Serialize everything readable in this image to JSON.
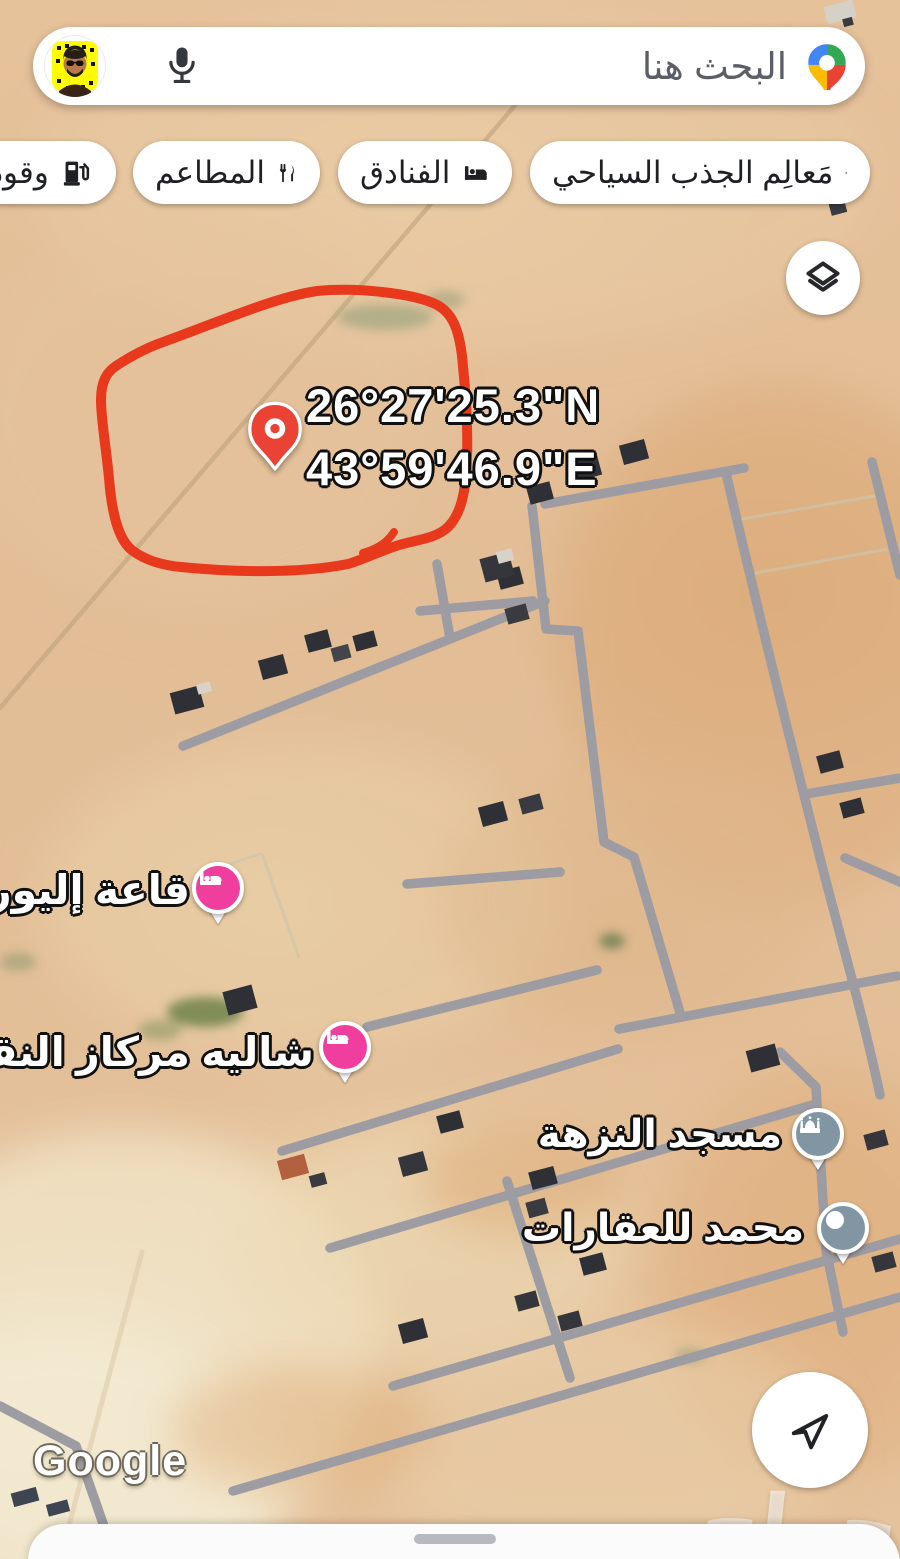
{
  "app": {
    "title": "Google Maps satellite view"
  },
  "search": {
    "placeholder": "البحث هنا"
  },
  "toolbar_chips": [
    {
      "label": "مَعالِم الجذب السياحي",
      "icon": "attractions-icon"
    },
    {
      "label": "الفنادق",
      "icon": "hotels-icon"
    },
    {
      "label": "المطاعم",
      "icon": "restaurants-icon"
    },
    {
      "label": "وقود",
      "icon": "fuel-icon"
    }
  ],
  "map": {
    "type": "satellite",
    "annotation": {
      "shape": "hand-drawn-circle",
      "color": "#e8391d"
    },
    "dropped_pin": {
      "color": "#ea4335",
      "coordinates": {
        "line1": "26°27'25.3\"N",
        "line2": "43°59'46.9\"E"
      }
    },
    "pois": [
      {
        "label": "قاعة إليور",
        "type": "lodging",
        "pin_color": "#ef3e9e",
        "icon": "bed-icon"
      },
      {
        "label": "شاليه مركاز النقيب",
        "type": "lodging",
        "pin_color": "#ef3e9e",
        "icon": "bed-icon"
      },
      {
        "label": "مسجد النزهة",
        "type": "mosque",
        "pin_color": "#8195a3",
        "icon": "mosque-icon"
      },
      {
        "label": "محمد للعقارات",
        "type": "place",
        "pin_color": "#8195a3",
        "icon": "dot-icon"
      }
    ],
    "attribution": "Google",
    "photo_watermark": "حراج"
  },
  "colors": {
    "road": "#9c9ca2",
    "sand": "#e2bd96",
    "annotation_red": "#e8391d",
    "pin_red": "#ea4335",
    "poi_pink": "#ef3e9e",
    "poi_gray": "#8195a3",
    "chip_text": "#1f2023",
    "placeholder_text": "#5b5e66"
  }
}
